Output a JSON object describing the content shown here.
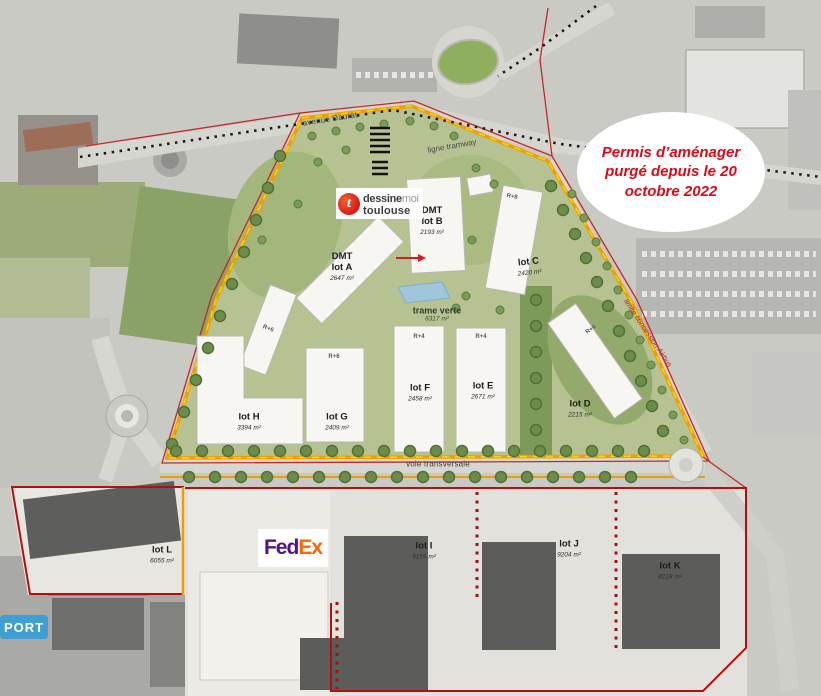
{
  "title_annotation": {
    "text": "Permis d’aménager purgé depuis le 20 octobre 2022",
    "color": "#e30613"
  },
  "logos": {
    "dmt": {
      "letter": "t",
      "word1": "dessine",
      "word2": "moi",
      "word3": "toulouse"
    },
    "fedex": {
      "part1": "Fed",
      "part2": "Ex",
      "color_fed": "#4d148c",
      "color_ex": "#ff6600"
    },
    "port": {
      "text": "PORT",
      "bg": "#3f9ed2"
    }
  },
  "roads": {
    "avenue": "avenue Daurat",
    "tramway": "ligne tramway",
    "transversale": "voie transversale",
    "limite": "limite concession Airbus"
  },
  "green_axis": {
    "label": "trame verte",
    "area": "6317 m²"
  },
  "lots": [
    {
      "name": "DMT\nlot A",
      "area": "2647 m²"
    },
    {
      "name": "DMT\nlot B",
      "area": "2193 m²"
    },
    {
      "name": "lot C",
      "area": "2420 m²"
    },
    {
      "name": "lot D",
      "area": "2215 m²"
    },
    {
      "name": "lot E",
      "area": "2671 m²"
    },
    {
      "name": "lot F",
      "area": "2458 m²"
    },
    {
      "name": "lot G",
      "area": "2409 m²"
    },
    {
      "name": "lot H",
      "area": "3394 m²"
    },
    {
      "name": "lot I",
      "area": "9155 m²"
    },
    {
      "name": "lot J",
      "area": "9204 m²"
    },
    {
      "name": "lot K",
      "area": "8218 m²"
    },
    {
      "name": "lot L",
      "area": "6055 m²"
    }
  ],
  "floor_labels": [
    "R+6",
    "R+6",
    "R+8",
    "R+4",
    "R+4",
    "R+4",
    "R+6"
  ],
  "colors": {
    "boundary_red": "#b40f0f",
    "ring_orange": "#ee9e00",
    "ring_yellow": "#ffd400",
    "site_green": "#b6c291"
  }
}
